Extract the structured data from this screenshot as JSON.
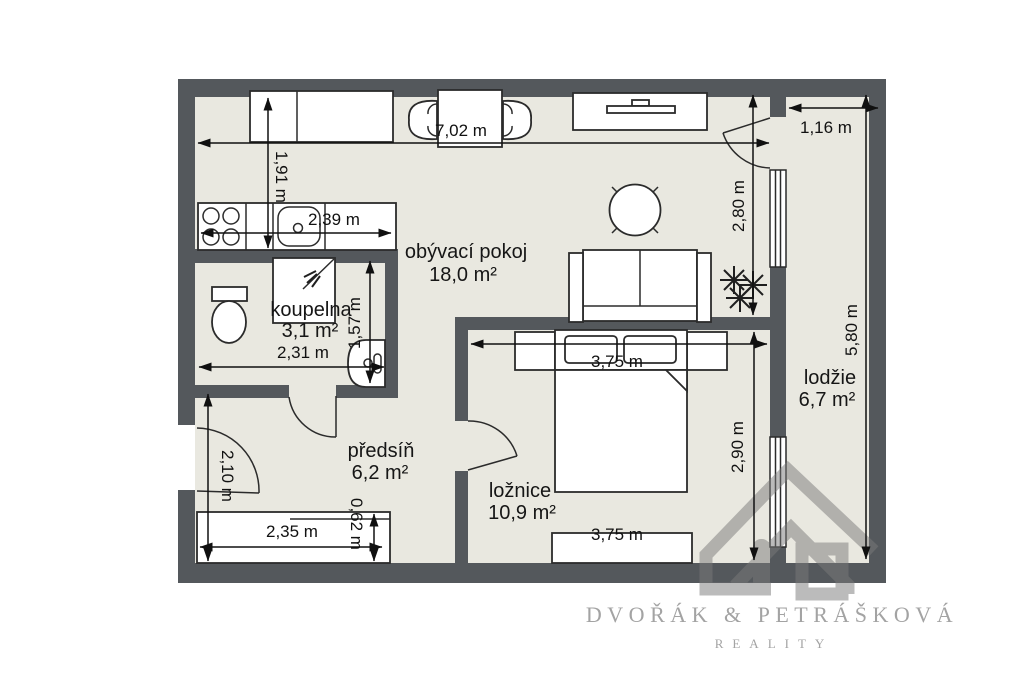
{
  "plan": {
    "rooms": [
      {
        "name": "obývací pokoj",
        "area": "18,0 m²"
      },
      {
        "name": "koupelna",
        "area": "3,1 m²"
      },
      {
        "name": "předsíň",
        "area": "6,2 m²"
      },
      {
        "name": "ložnice",
        "area": "10,9 m²"
      },
      {
        "name": "lodžie",
        "area": "6,7 m²"
      }
    ],
    "dims": {
      "top_width": "7,02 m",
      "kitchen_depth": "1,91 m",
      "counter_length": "2,39 m",
      "loggia_width": "1,16 m",
      "living_height": "2,80 m",
      "right_height": "5,80 m",
      "bath_width": "2,31 m",
      "bath_depth": "1,57 m",
      "bedroom_width_top": "3,75 m",
      "bedroom_height": "2,90 m",
      "bedroom_width_bottom": "3,75 m",
      "hall_door_height": "2,10 m",
      "wardrobe_width": "2,35 m",
      "wardrobe_depth": "0,62 m"
    },
    "colors": {
      "wall": "#54585c",
      "floor": "#e9e8e0",
      "dimension_line": "#111111",
      "label_text": "#161616",
      "brand_text": "#a3a3a3",
      "watermark": "#7a7a7a"
    }
  },
  "branding": {
    "name": "DVOŘÁK & PETRÁŠKOVÁ",
    "tagline": "REALITY"
  }
}
